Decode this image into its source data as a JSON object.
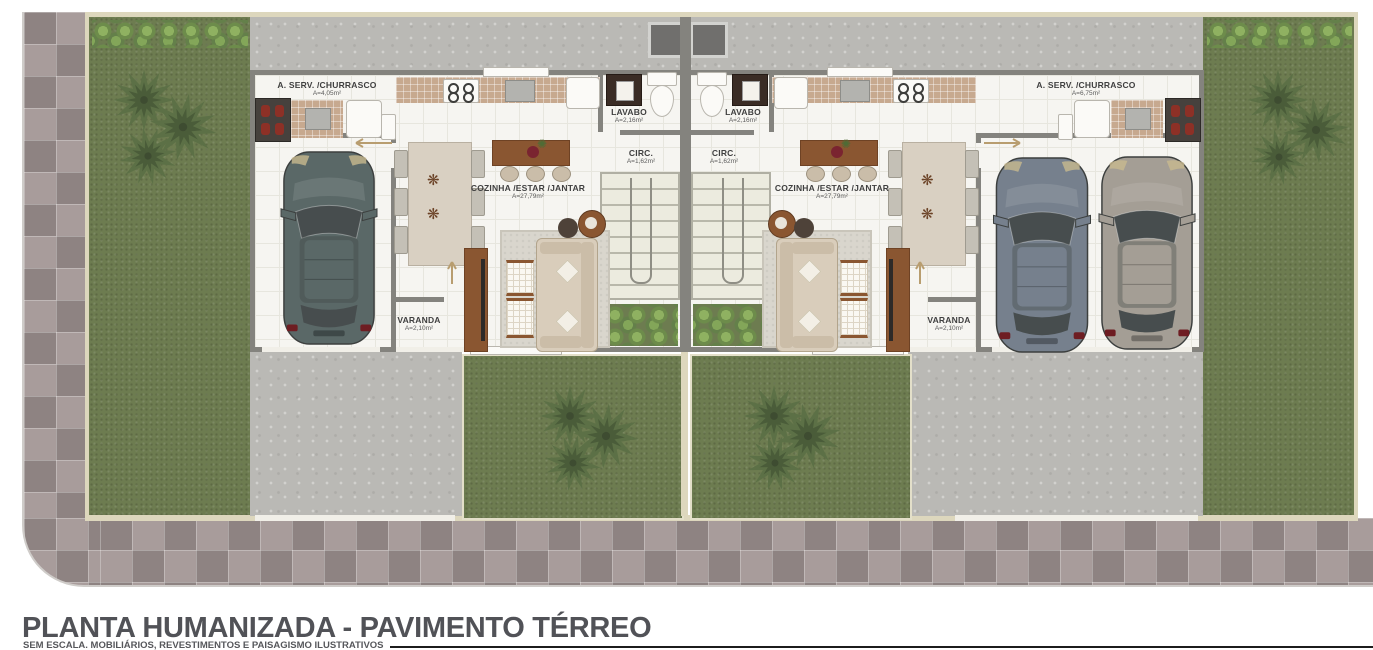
{
  "title": {
    "main": "PLANTA HUMANIZADA - PAVIMENTO TÉRREO",
    "subtitle": "SEM ESCALA. MOBILIÁRIOS, REVESTIMENTOS E PAISAGISMO ILUSTRATIVOS"
  },
  "units": {
    "left": {
      "service_name": "A. SERV. /CHURRASCO",
      "service_area": "A=4,05m²",
      "lavabo_name": "LAVABO",
      "lavabo_area": "A=2,16m²",
      "circ_name": "CIRC.",
      "circ_area": "A=1,62m²",
      "living_name": "COZINHA /ESTAR /JANTAR",
      "living_area": "A=27,79m²",
      "varanda_name": "VARANDA",
      "varanda_area": "A=2,10m²"
    },
    "right": {
      "service_name": "A. SERV. /CHURRASCO",
      "service_area": "A=6,75m²",
      "lavabo_name": "LAVABO",
      "lavabo_area": "A=2,16m²",
      "circ_name": "CIRC.",
      "circ_area": "A=1,62m²",
      "living_name": "COZINHA /ESTAR /JANTAR",
      "living_area": "A=27,79m²",
      "varanda_name": "VARANDA",
      "varanda_area": "A=2,10m²"
    }
  },
  "colors": {
    "grass": "#6d7c50",
    "shrub": "#5c7046",
    "hedge": "#83a659",
    "concrete": "#bab9b5",
    "paver": "#9d9291",
    "wall": "#84837e",
    "wood": "#8a5631",
    "floor": "#f6f5f1",
    "car_left": "#5a6867",
    "car_right_blue": "#76808d",
    "car_right_silver": "#a49e95"
  }
}
